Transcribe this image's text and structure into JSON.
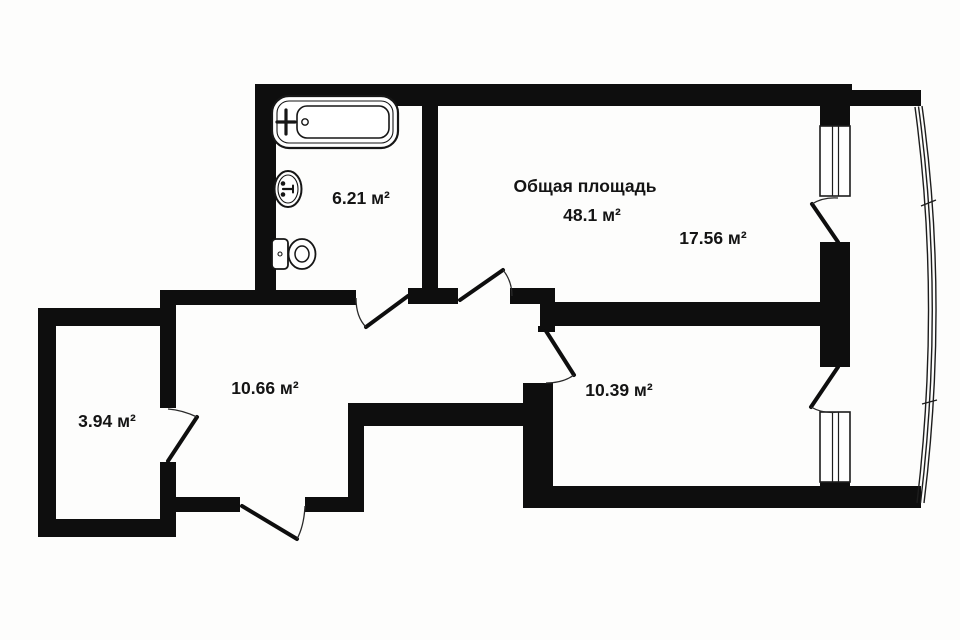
{
  "colors": {
    "wall": "#0e0e0e",
    "background": "#fdfdfc",
    "thin_line": "#1d1d1d"
  },
  "labels": {
    "total_title": "Общая площадь",
    "total_area": "48.1 м²",
    "living_room": "17.56 м²",
    "bathroom": "6.21 м²",
    "hallway": "10.66 м²",
    "bedroom": "10.39 м²",
    "storage": "3.94 м²"
  }
}
